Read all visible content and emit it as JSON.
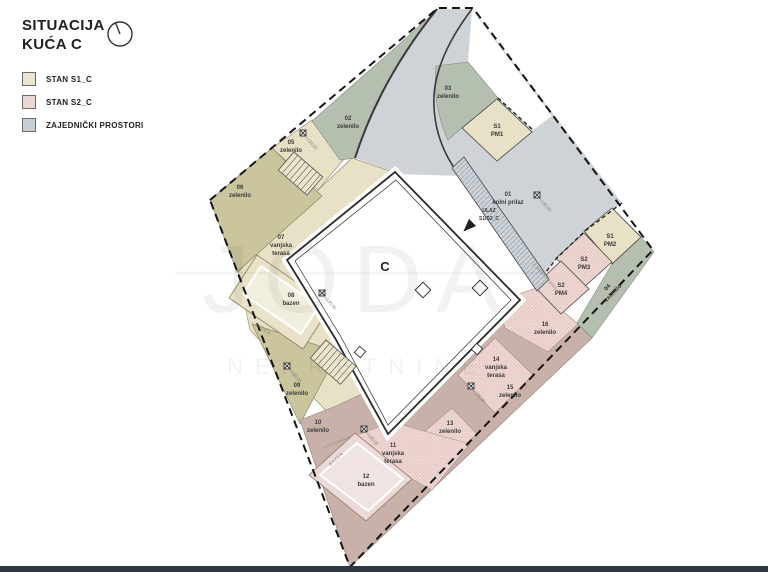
{
  "header": {
    "title1": "SITUACIJA",
    "title2": "KUĆA C"
  },
  "legend": {
    "items": [
      {
        "label": "STAN S1_C",
        "color": "#eae5cc"
      },
      {
        "label": "STAN S2_C",
        "color": "#ead8d3"
      },
      {
        "label": "ZAJEDNIČKI PROSTORI",
        "color": "#c6cfd4"
      }
    ]
  },
  "plan": {
    "building_label": "C",
    "entrance": {
      "line1": "ULAZ",
      "line2": "S1/S2_C"
    },
    "pool_label": "BAZEN",
    "walkway_note": "2 parkirna mjesta",
    "elevation": "+135,00",
    "zones": [
      {
        "num": "01",
        "lines": [
          "kolni prilaz"
        ]
      },
      {
        "num": "02",
        "lines": [
          "zelenilo"
        ]
      },
      {
        "num": "03",
        "lines": [
          "zelenilo"
        ]
      },
      {
        "num": "04",
        "lines": [
          "zelenilo"
        ]
      },
      {
        "num": "05",
        "lines": [
          "zelenilo"
        ]
      },
      {
        "num": "06",
        "lines": [
          "zelenilo"
        ]
      },
      {
        "num": "07",
        "lines": [
          "vanjska",
          "terasa"
        ]
      },
      {
        "num": "08",
        "lines": [
          "bazen"
        ]
      },
      {
        "num": "09",
        "lines": [
          "zelenilo"
        ]
      },
      {
        "num": "10",
        "lines": [
          "zelenilo"
        ]
      },
      {
        "num": "11",
        "lines": [
          "vanjska",
          "terasa"
        ]
      },
      {
        "num": "12",
        "lines": [
          "bazen"
        ]
      },
      {
        "num": "13",
        "lines": [
          "zelenilo"
        ]
      },
      {
        "num": "14",
        "lines": [
          "vanjska",
          "terasa"
        ]
      },
      {
        "num": "15",
        "lines": [
          "zelenilo"
        ]
      },
      {
        "num": "16",
        "lines": [
          "zelenilo"
        ]
      }
    ],
    "parking": [
      {
        "unit": "S1",
        "spot": "PM1"
      },
      {
        "unit": "S1",
        "spot": "PM2"
      },
      {
        "unit": "S2",
        "spot": "PM3"
      },
      {
        "unit": "S2",
        "spot": "PM4"
      }
    ]
  },
  "watermark": {
    "line1": "JODA",
    "line2": "NEKRETNINE"
  },
  "colors": {
    "road": "#cdd3d7",
    "green_common": "#b5bfb0",
    "olive_s1": "#cac59c",
    "cream_s1": "#ece6cc",
    "pink_s2": "#f0d9d5",
    "dusty_s2": "#c8b1a9",
    "boundary": "#151515",
    "bottom_bar": "#2e3842"
  }
}
